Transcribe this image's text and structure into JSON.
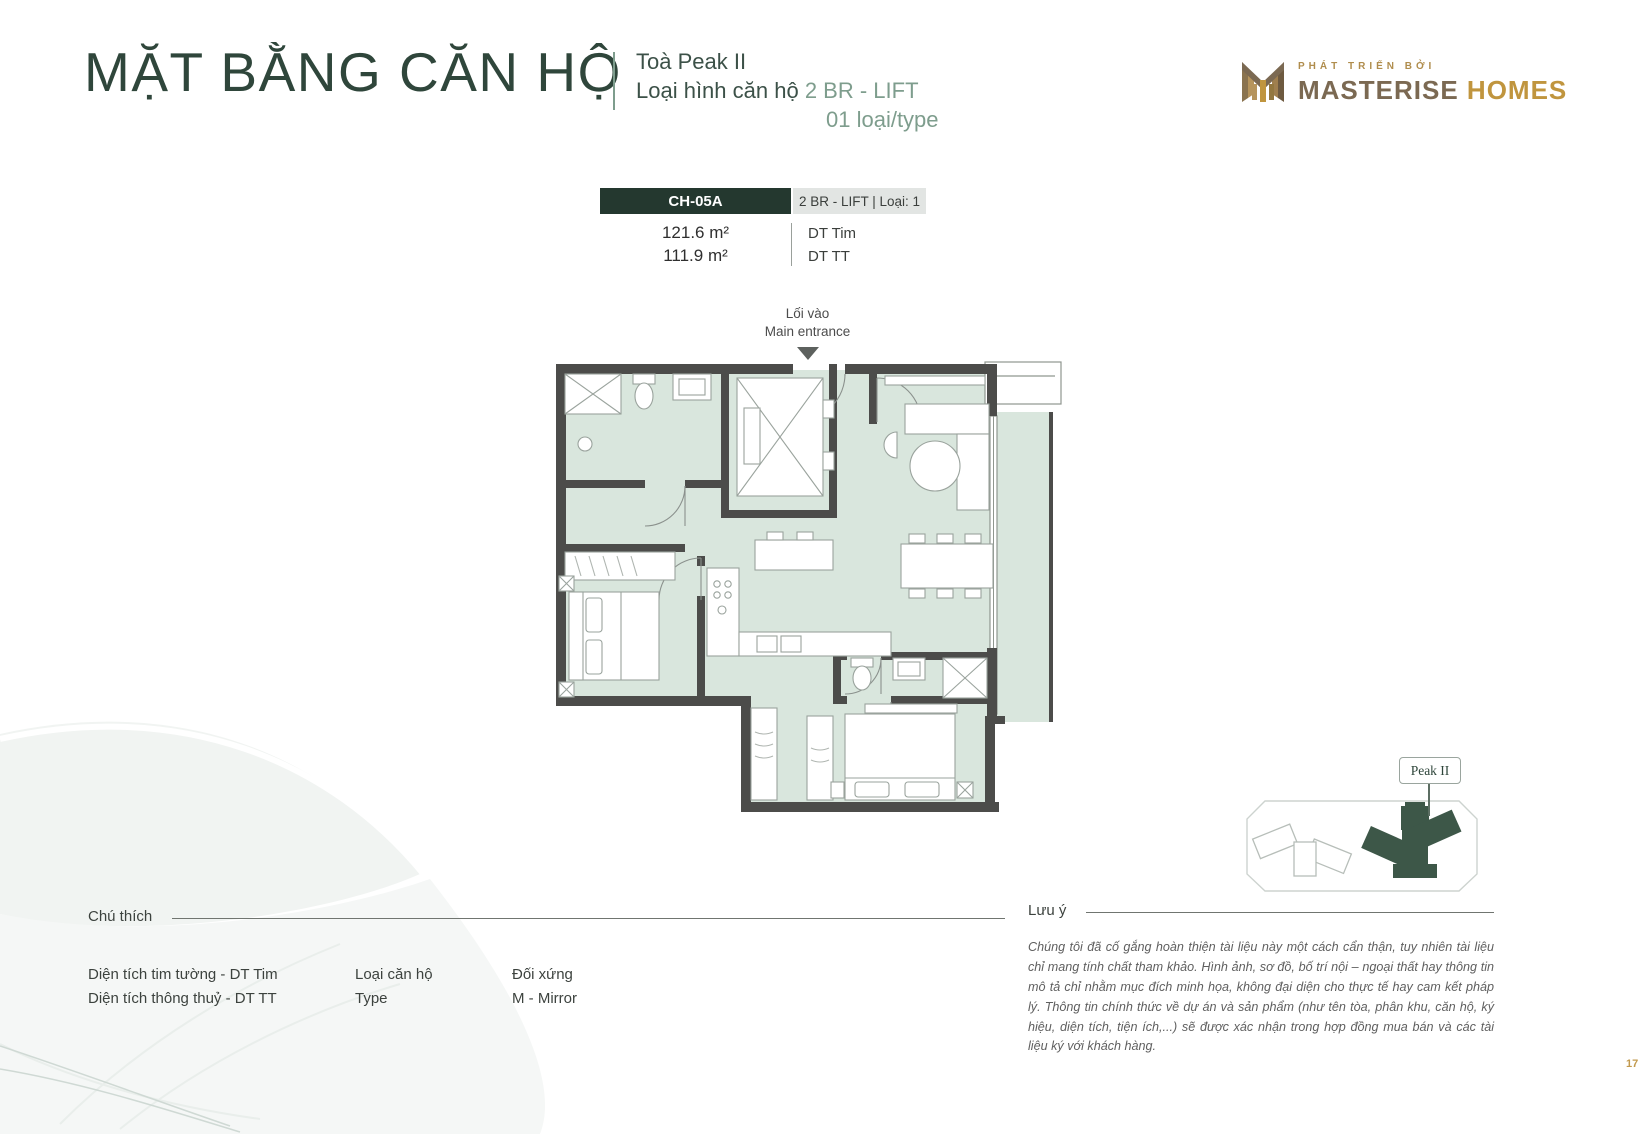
{
  "page": {
    "title": "MẶT BẰNG CĂN HỘ",
    "page_number": "17"
  },
  "header": {
    "subtitle_line1": "Toà Peak II",
    "subtitle_line2_label": "Loại hình căn hộ",
    "subtitle_line2_value": "2 BR - LIFT",
    "subtitle_line3": "01 loại/type"
  },
  "logo": {
    "tagline": "PHÁT TRIỂN BỞI",
    "brand_primary": "MASTERISE",
    "brand_secondary": "HOMES"
  },
  "unit_card": {
    "unit_code": "CH-05A",
    "unit_type": "2 BR - LIFT | Loại: 1",
    "area_rows": [
      {
        "value": "121.6 m²",
        "label": "DT Tim"
      },
      {
        "value": "111.9 m²",
        "label": "DT TT"
      }
    ]
  },
  "floor_plan": {
    "entrance_label_vi": "Lối vào",
    "entrance_label_en": "Main entrance"
  },
  "mini_map": {
    "label": "Peak II"
  },
  "legend": {
    "heading": "Chú thích",
    "columns": [
      {
        "line1": "Diện tích tim tường - DT Tim",
        "line2": "Diện tích thông thuỷ - DT TT"
      },
      {
        "line1": "Loại căn hộ",
        "line2": "Type"
      },
      {
        "line1": "Đối xứng",
        "line2": "M - Mirror"
      }
    ]
  },
  "note": {
    "heading": "Lưu ý",
    "body": "Chúng tôi đã cố gắng hoàn thiện tài liệu này một cách cẩn thận, tuy nhiên tài liệu chỉ mang tính chất tham khảo. Hình ảnh, sơ đồ, bố trí nội – ngoại thất hay thông tin mô tả chỉ nhằm mục đích minh họa, không đại diện cho thực tế hay cam kết pháp lý. Thông tin chính thức về dự án và sản phẩm (như tên tòa, phân khu, căn hộ, ký hiệu, diện tích, tiện ích,...) sẽ được xác nhận trong hợp đồng mua bán và các tài liệu ký với khách hàng."
  },
  "colors": {
    "dark_green": "#2f463b",
    "sage_green": "#7e9d8d",
    "header_cell_green": "#24382f",
    "floor_fill": "#d9e6dd",
    "wall_gray": "#4c4c4a",
    "gold": "#c0953e",
    "brand_brown": "#7b6952"
  }
}
